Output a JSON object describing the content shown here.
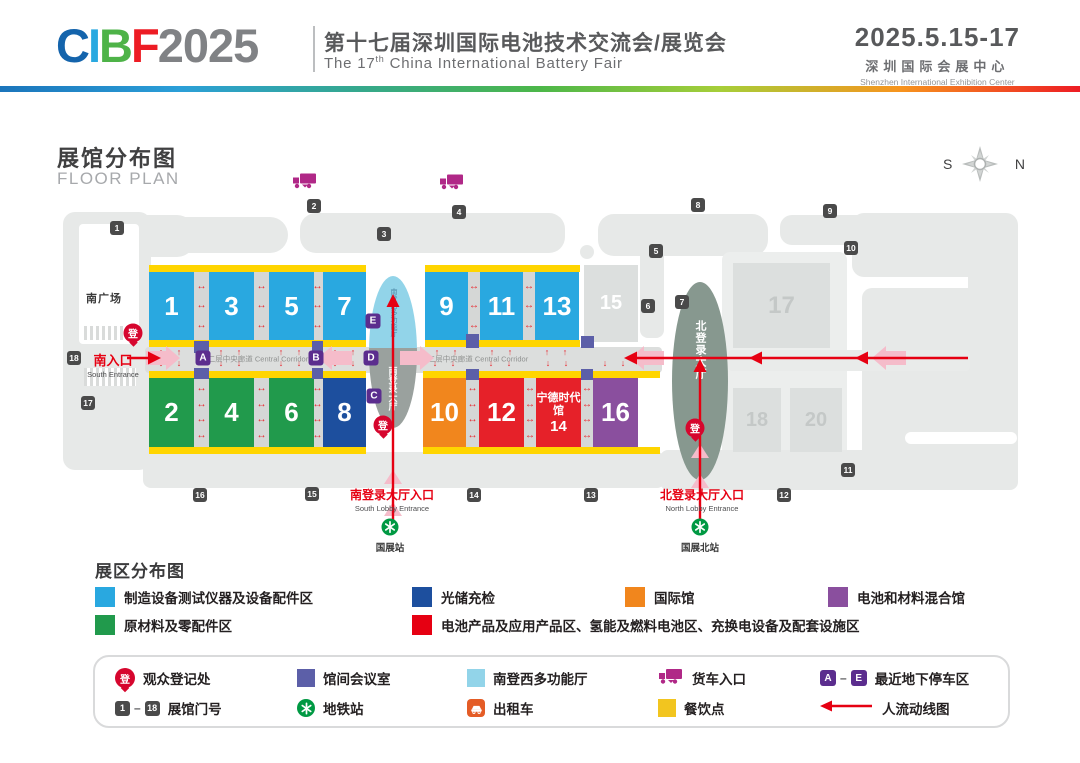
{
  "header": {
    "logo": {
      "c": "C",
      "i": "I",
      "b": "B",
      "f": "F",
      "year": "2025"
    },
    "title_zh": "第十七届深圳国际电池技术交流会/展览会",
    "title_en_pre": "The 17",
    "title_en_sup": "th",
    "title_en_post": " China International Battery Fair",
    "date": "2025.5.15-17",
    "venue_zh": "深圳国际会展中心",
    "venue_en": "Shenzhen International Exhibition Center"
  },
  "plan_header": {
    "title_zh": "展馆分布图",
    "title_en": "FLOOR PLAN",
    "compass_s": "S",
    "compass_n": "N"
  },
  "plan": {
    "plaza_label": "南广场",
    "corridor_label": "二层中央廊道 Central Corridor",
    "corridor_label_positions": [
      {
        "x": 258,
        "y": 359
      },
      {
        "x": 478,
        "y": 359
      }
    ],
    "reg_char": "登",
    "reg_points": [
      {
        "x": 133,
        "y": 333
      },
      {
        "x": 383,
        "y": 425
      },
      {
        "x": 695,
        "y": 428
      }
    ],
    "south_lobby": {
      "multi_label": "南登西多功能厅",
      "lobby_label": "南登录大厅"
    },
    "north_lobby": {
      "label": "北登录大厅"
    },
    "catl": {
      "line1": "宁德时代馆",
      "line2": "14"
    },
    "halls": [
      {
        "n": "1",
        "x": 149,
        "y": 272,
        "w": 45,
        "h": 68,
        "c": "blue"
      },
      {
        "n": "3",
        "x": 209,
        "y": 272,
        "w": 45,
        "h": 68,
        "c": "blue"
      },
      {
        "n": "5",
        "x": 269,
        "y": 272,
        "w": 45,
        "h": 68,
        "c": "blue"
      },
      {
        "n": "7",
        "x": 323,
        "y": 272,
        "w": 43,
        "h": 68,
        "c": "blue"
      },
      {
        "n": "9",
        "x": 425,
        "y": 272,
        "w": 43,
        "h": 68,
        "c": "blue"
      },
      {
        "n": "11",
        "x": 480,
        "y": 272,
        "w": 43,
        "h": 68,
        "c": "blue"
      },
      {
        "n": "13",
        "x": 535,
        "y": 272,
        "w": 44,
        "h": 68,
        "c": "blue"
      },
      {
        "n": "15",
        "x": 584,
        "y": 265,
        "w": 54,
        "h": 77,
        "c": "gray",
        "tc": "#ffffff",
        "fs": 20
      },
      {
        "n": "2",
        "x": 149,
        "y": 378,
        "w": 45,
        "h": 69,
        "c": "green"
      },
      {
        "n": "4",
        "x": 209,
        "y": 378,
        "w": 45,
        "h": 69,
        "c": "green"
      },
      {
        "n": "6",
        "x": 269,
        "y": 378,
        "w": 45,
        "h": 69,
        "c": "green"
      },
      {
        "n": "8",
        "x": 323,
        "y": 378,
        "w": 43,
        "h": 69,
        "c": "navy"
      },
      {
        "n": "10",
        "x": 423,
        "y": 378,
        "w": 43,
        "h": 69,
        "c": "orange"
      },
      {
        "n": "12",
        "x": 479,
        "y": 378,
        "w": 45,
        "h": 69,
        "c": "red"
      },
      {
        "n": "14",
        "x": 536,
        "y": 378,
        "w": 45,
        "h": 69,
        "c": "red",
        "catl": true
      },
      {
        "n": "16",
        "x": 593,
        "y": 378,
        "w": 45,
        "h": 69,
        "c": "purple"
      },
      {
        "n": "17",
        "x": 733,
        "y": 263,
        "w": 97,
        "h": 85,
        "c": "gray2",
        "tc": "#c4c8c7",
        "fs": 24
      },
      {
        "n": "18",
        "x": 733,
        "y": 388,
        "w": 48,
        "h": 64,
        "c": "gray2",
        "tc": "#c4c8c7",
        "fs": 20
      },
      {
        "n": "20",
        "x": 790,
        "y": 388,
        "w": 52,
        "h": 64,
        "c": "gray2",
        "tc": "#c4c8c7",
        "fs": 20
      }
    ],
    "strips": [
      {
        "x": 149,
        "y": 265,
        "w": 217
      },
      {
        "x": 425,
        "y": 265,
        "w": 155
      },
      {
        "x": 149,
        "y": 340,
        "w": 217
      },
      {
        "x": 425,
        "y": 340,
        "w": 155
      },
      {
        "x": 149,
        "y": 371,
        "w": 217
      },
      {
        "x": 423,
        "y": 371,
        "w": 237
      },
      {
        "x": 149,
        "y": 447,
        "w": 217
      },
      {
        "x": 423,
        "y": 447,
        "w": 237
      }
    ],
    "gaps": [
      {
        "x": 194,
        "y": 272,
        "w": 15,
        "h": 68,
        "a": 3
      },
      {
        "x": 254,
        "y": 272,
        "w": 15,
        "h": 68,
        "a": 3
      },
      {
        "x": 312,
        "y": 272,
        "w": 11,
        "h": 68,
        "a": 3
      },
      {
        "x": 468,
        "y": 272,
        "w": 12,
        "h": 68,
        "a": 3
      },
      {
        "x": 523,
        "y": 272,
        "w": 12,
        "h": 68,
        "a": 3
      },
      {
        "x": 194,
        "y": 378,
        "w": 15,
        "h": 69,
        "a": 4
      },
      {
        "x": 254,
        "y": 378,
        "w": 15,
        "h": 69,
        "a": 4
      },
      {
        "x": 312,
        "y": 378,
        "w": 11,
        "h": 69,
        "a": 4
      },
      {
        "x": 466,
        "y": 378,
        "w": 13,
        "h": 69,
        "a": 4
      },
      {
        "x": 524,
        "y": 378,
        "w": 12,
        "h": 69,
        "a": 4
      },
      {
        "x": 581,
        "y": 378,
        "w": 12,
        "h": 69,
        "a": 4
      }
    ],
    "meeting_squares": [
      {
        "x": 194,
        "y": 341,
        "w": 15,
        "h": 12
      },
      {
        "x": 312,
        "y": 341,
        "w": 11,
        "h": 12
      },
      {
        "x": 194,
        "y": 368,
        "w": 15,
        "h": 11
      },
      {
        "x": 312,
        "y": 368,
        "w": 11,
        "h": 11
      },
      {
        "x": 466,
        "y": 334,
        "w": 13,
        "h": 14
      },
      {
        "x": 581,
        "y": 336,
        "w": 13,
        "h": 12
      },
      {
        "x": 466,
        "y": 369,
        "w": 13,
        "h": 11
      },
      {
        "x": 581,
        "y": 369,
        "w": 12,
        "h": 11
      }
    ],
    "gates": [
      {
        "n": "1",
        "x": 117,
        "y": 228
      },
      {
        "n": "2",
        "x": 314,
        "y": 206
      },
      {
        "n": "3",
        "x": 384,
        "y": 234
      },
      {
        "n": "4",
        "x": 459,
        "y": 212
      },
      {
        "n": "5",
        "x": 656,
        "y": 251
      },
      {
        "n": "6",
        "x": 648,
        "y": 306
      },
      {
        "n": "7",
        "x": 682,
        "y": 302
      },
      {
        "n": "8",
        "x": 698,
        "y": 205
      },
      {
        "n": "9",
        "x": 830,
        "y": 211
      },
      {
        "n": "10",
        "x": 851,
        "y": 248
      },
      {
        "n": "11",
        "x": 848,
        "y": 470
      },
      {
        "n": "12",
        "x": 784,
        "y": 495
      },
      {
        "n": "13",
        "x": 591,
        "y": 495
      },
      {
        "n": "14",
        "x": 474,
        "y": 495
      },
      {
        "n": "15",
        "x": 312,
        "y": 494
      },
      {
        "n": "16",
        "x": 200,
        "y": 495
      },
      {
        "n": "17",
        "x": 88,
        "y": 403
      },
      {
        "n": "18",
        "x": 74,
        "y": 358
      }
    ],
    "markers": [
      {
        "l": "A",
        "x": 203,
        "y": 358
      },
      {
        "l": "B",
        "x": 316,
        "y": 358
      },
      {
        "l": "C",
        "x": 374,
        "y": 396
      },
      {
        "l": "D",
        "x": 371,
        "y": 358
      },
      {
        "l": "E",
        "x": 373,
        "y": 321
      }
    ],
    "trucks": [
      {
        "x": 305,
        "y": 183
      },
      {
        "x": 452,
        "y": 184
      }
    ],
    "entrances": {
      "south": {
        "zh": "南入口",
        "en": "South Entrance",
        "x": 113,
        "y": 350
      },
      "south_lobby": {
        "zh": "南登录大厅入口",
        "en": "South Lobby Entrance",
        "x": 392,
        "y": 486
      },
      "north_lobby": {
        "zh": "北登录大厅入口",
        "en": "North Lobby Entrance",
        "x": 702,
        "y": 486
      }
    },
    "metros": [
      {
        "label": "国展站",
        "x": 390,
        "y": 527
      },
      {
        "label": "国展北站",
        "x": 700,
        "y": 527
      }
    ]
  },
  "zone_legend": {
    "title": "展区分布图",
    "items": [
      {
        "color": "#29a8e0",
        "label": "制造设备测试仪器及设备配件区",
        "x": 95,
        "y": 586
      },
      {
        "color": "#219a4c",
        "label": "原材料及零配件区",
        "x": 95,
        "y": 614
      },
      {
        "color": "#1d4f9e",
        "label": "光储充检",
        "x": 412,
        "y": 586
      },
      {
        "color": "#e60012",
        "label": "电池产品及应用产品区、氢能及燃料电池区、充换电设备及配套设施区",
        "x": 412,
        "y": 614
      },
      {
        "color": "#f1861d",
        "label": "国际馆",
        "x": 625,
        "y": 586
      },
      {
        "color": "#8a4f9e",
        "label": "电池和材料混合馆",
        "x": 828,
        "y": 586
      }
    ]
  },
  "icon_legend": {
    "reg_char": "登",
    "ae": {
      "a": "A",
      "dash": "–",
      "e": "E"
    },
    "gate_range": {
      "g1": "1",
      "dash": "–",
      "g18": "18"
    },
    "items": [
      {
        "icon": "reg",
        "label": "观众登记处",
        "x": 115,
        "y": 666
      },
      {
        "icon": "meeting",
        "label": "馆间会议室",
        "x": 297,
        "y": 666
      },
      {
        "icon": "multi",
        "label": "南登西多功能厅",
        "x": 467,
        "y": 666
      },
      {
        "icon": "truck",
        "label": "货车入口",
        "x": 658,
        "y": 666
      },
      {
        "icon": "ae",
        "label": "最近地下停车区",
        "x": 820,
        "y": 666
      },
      {
        "icon": "gates",
        "label": "展馆门号",
        "x": 115,
        "y": 696
      },
      {
        "icon": "metro",
        "label": "地铁站",
        "x": 297,
        "y": 696
      },
      {
        "icon": "taxi",
        "label": "出租车",
        "x": 467,
        "y": 696
      },
      {
        "icon": "food",
        "label": "餐饮点",
        "x": 658,
        "y": 696
      },
      {
        "icon": "flow",
        "label": "人流动线图",
        "x": 820,
        "y": 696
      }
    ]
  },
  "colors": {
    "hall_blue": "#29a8e0",
    "hall_green": "#219a4c",
    "hall_navy": "#1d4f9e",
    "hall_orange": "#f1861d",
    "hall_red": "#e62129",
    "hall_purple": "#8a4f9e",
    "hall_gray": "#dcdfde",
    "yellow": "#ffd500",
    "meeting_purple": "#5c5fa8",
    "multi_blue": "#92d4e9",
    "south_lobby_gray": "#9aa19e",
    "north_lobby_sage": "#87988f",
    "gate_gray": "#4a4a4a",
    "accent_red": "#e60012",
    "metro_green": "#009943",
    "truck_magenta": "#b02887",
    "taxi_orange": "#e45c26",
    "marker_purple": "#5b2d8e",
    "food_yellow": "#f2c51f"
  }
}
